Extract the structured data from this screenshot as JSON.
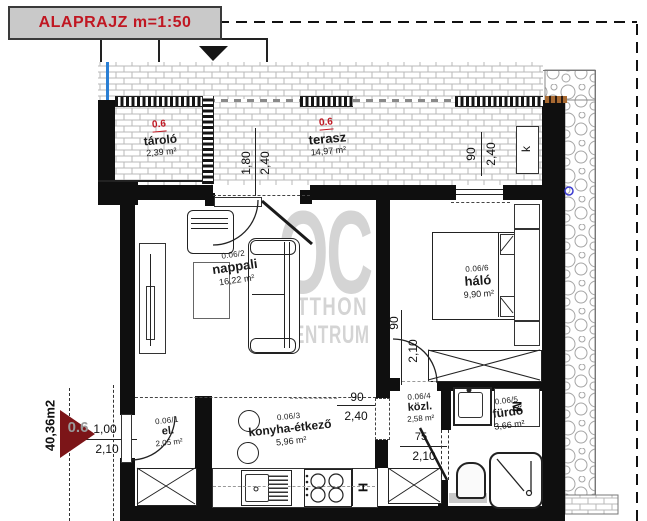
{
  "title": "ALAPRAJZ  m=1:50",
  "unit": {
    "number": "0.6",
    "total_area": "40,36m2"
  },
  "watermark": {
    "logo": "OC",
    "line1": "OTTHON",
    "line2": "CENTRUM"
  },
  "rooms": {
    "tarolo": {
      "code": "0.6",
      "name": "tároló",
      "area": "2,39 m²"
    },
    "terasz": {
      "code": "0.6",
      "name": "terasz",
      "area": "14,97 m²"
    },
    "nappali": {
      "code": "0.06/2",
      "name": "nappali",
      "area": "16,22 m²"
    },
    "halo": {
      "code": "0.06/6",
      "name": "háló",
      "area": "9,90 m²"
    },
    "el": {
      "code": "0.06/1",
      "name": "el.",
      "area": "2,05 m²"
    },
    "konyha": {
      "code": "0.06/3",
      "name": "konyha-étkező",
      "area": "5,96 m²"
    },
    "kozl": {
      "code": "0.06/4",
      "name": "közl.",
      "area": "2,58 m²"
    },
    "furdo": {
      "code": "0.06/5",
      "name": "fürdő",
      "area": "3,66 m²"
    }
  },
  "dimensions": {
    "terasz_door_width": "1,80",
    "terasz_door_height": "2,40",
    "halo_window_width": "90",
    "halo_window_height": "2,40",
    "halo_door_width": "90",
    "halo_door_height": "2,10",
    "konyha_opening_width": "90",
    "konyha_opening_height": "2,40",
    "entry_door_width": "1,00",
    "entry_door_height": "2,10",
    "furdo_door_width": "75",
    "furdo_door_height": "2,10"
  },
  "appliance_labels": {
    "fridge": "H",
    "washing_machine": "M",
    "chimney": "k"
  },
  "colors": {
    "title_red": "#c01722",
    "wall_black": "#0f0f0f",
    "arrow_dark_red": "#7c1518",
    "watermark_gray": "#d4d4d4",
    "pipe_blue": "#2a7fd4",
    "drain_blue": "#3b3bd0",
    "title_bg_gray": "#c9c9c9"
  }
}
